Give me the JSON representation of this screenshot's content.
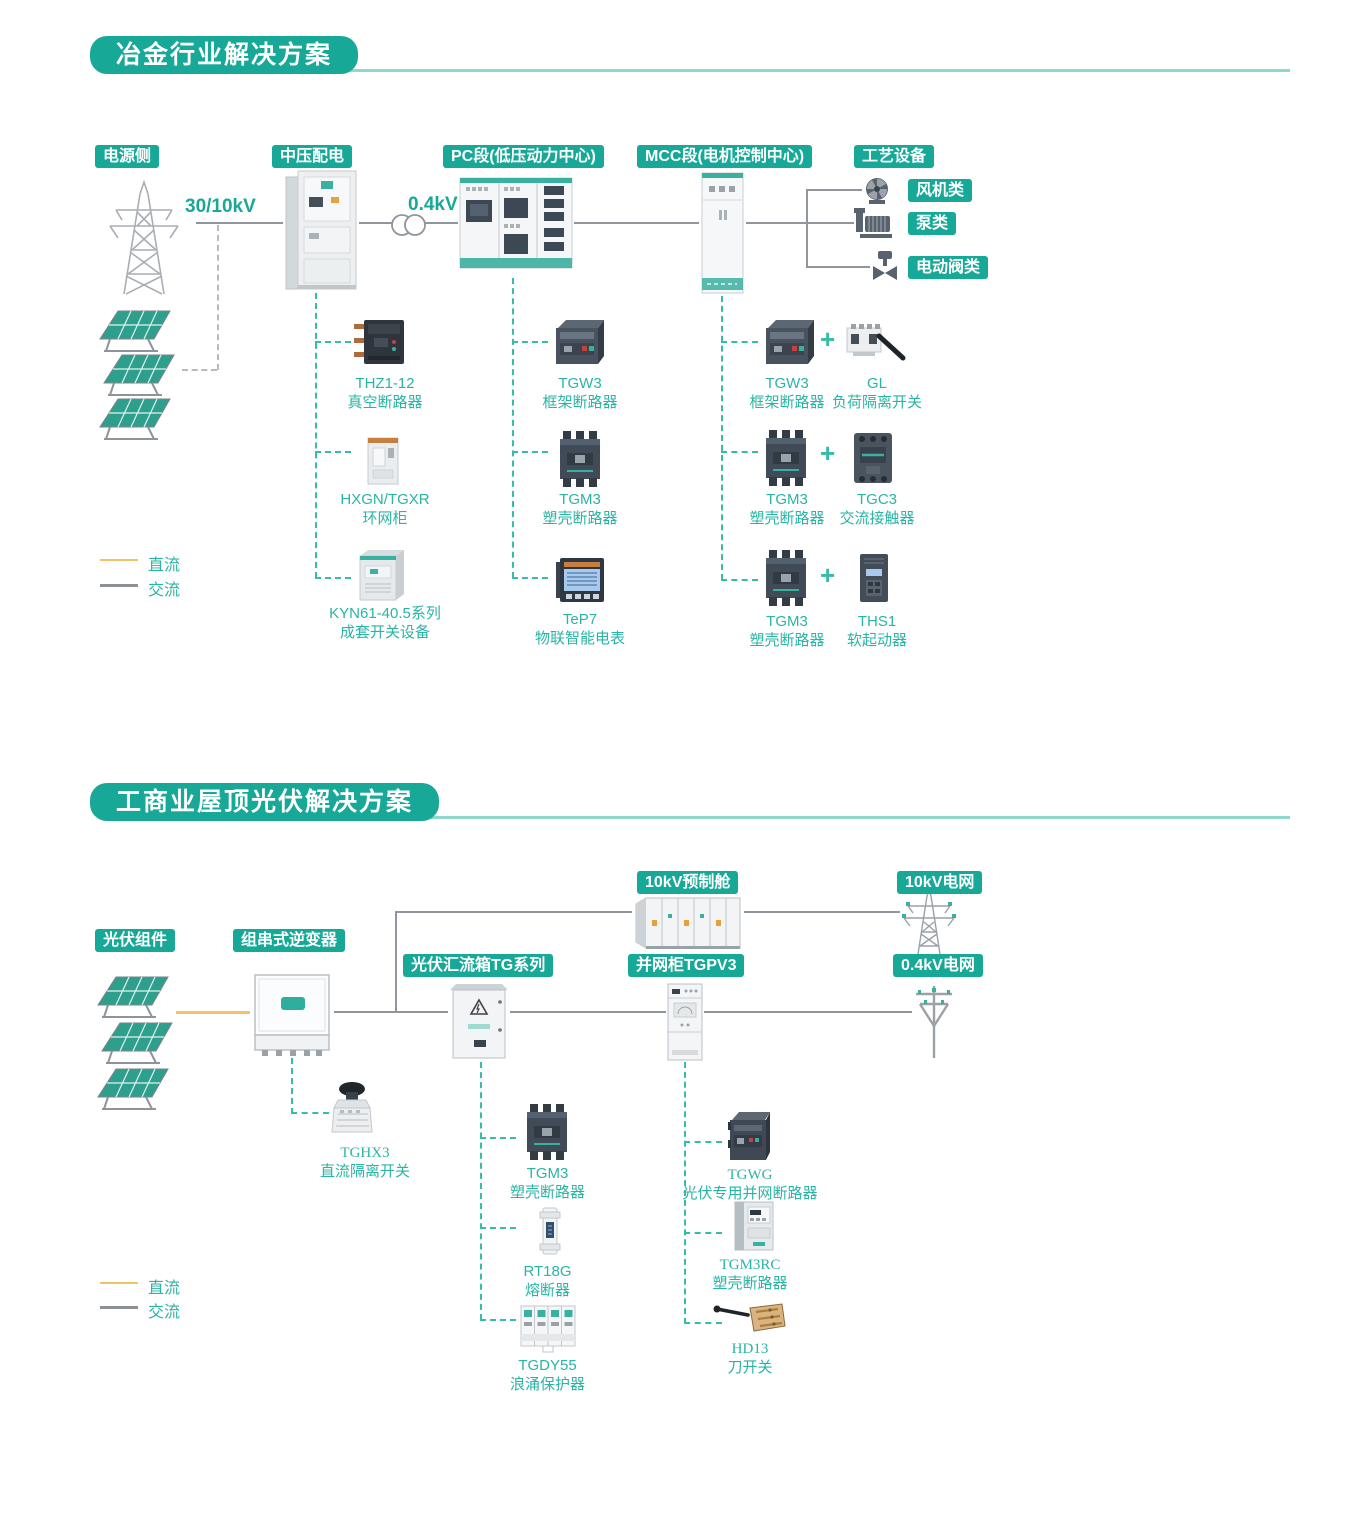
{
  "colors": {
    "accent_teal": "#17a897",
    "teal_text": "#2ab4a4",
    "dc_line": "#f2c266",
    "ac_line": "#90969b",
    "dashed_teal": "#36bcab"
  },
  "s1": {
    "title": "冶金行业解决方案",
    "stages": {
      "source": "电源侧",
      "mv": "中压配电",
      "pc": "PC段(低压动力中心)",
      "mcc": "MCC段(电机控制中心)",
      "process": "工艺设备"
    },
    "voltages": {
      "v1": "30/10kV",
      "v2": "0.4kV"
    },
    "equipment": {
      "fan": "风机类",
      "pump": "泵类",
      "valve": "电动阀类"
    },
    "mv_items": [
      {
        "model": "THZ1-12",
        "desc": "真空断路器"
      },
      {
        "model": "HXGN/TGXR",
        "desc": "环网柜"
      },
      {
        "model": "KYN61-40.5系列",
        "desc": "成套开关设备"
      }
    ],
    "pc_items": [
      {
        "model": "TGW3",
        "desc": "框架断路器"
      },
      {
        "model": "TGM3",
        "desc": "塑壳断路器"
      },
      {
        "model": "TeP7",
        "desc": "物联智能电表"
      }
    ],
    "mcc_pairs": [
      {
        "a_model": "TGW3",
        "a_desc": "框架断路器",
        "plus": "+",
        "b_model": "GL",
        "b_desc": "负荷隔离开关"
      },
      {
        "a_model": "TGM3",
        "a_desc": "塑壳断路器",
        "plus": "+",
        "b_model": "TGC3",
        "b_desc": "交流接触器"
      },
      {
        "a_model": "TGM3",
        "a_desc": "塑壳断路器",
        "plus": "+",
        "b_model": "THS1",
        "b_desc": "软起动器"
      }
    ],
    "legend": {
      "dc": "直流",
      "ac": "交流"
    }
  },
  "s2": {
    "title": "工商业屋顶光伏解决方案",
    "stages": {
      "pv": "光伏组件",
      "inverter": "组串式逆变器",
      "combiner": "光伏汇流箱TG系列",
      "grid_cabinet": "并网柜TGPV3",
      "prefab": "10kV预制舱",
      "grid_10kv": "10kV电网",
      "grid_04kv": "0.4kV电网"
    },
    "inverter_item": {
      "model": "TGHX3",
      "desc": "直流隔离开关"
    },
    "combiner_items": [
      {
        "model": "TGM3",
        "desc": "塑壳断路器"
      },
      {
        "model": "RT18G",
        "desc": "熔断器"
      },
      {
        "model": "TGDY55",
        "desc": "浪涌保护器"
      }
    ],
    "grid_items": [
      {
        "model": "TGWG",
        "desc": "光伏专用并网断路器"
      },
      {
        "model": "TGM3RC",
        "desc": "塑壳断路器"
      },
      {
        "model": "HD13",
        "desc": "刀开关"
      }
    ],
    "legend": {
      "dc": "直流",
      "ac": "交流"
    }
  }
}
